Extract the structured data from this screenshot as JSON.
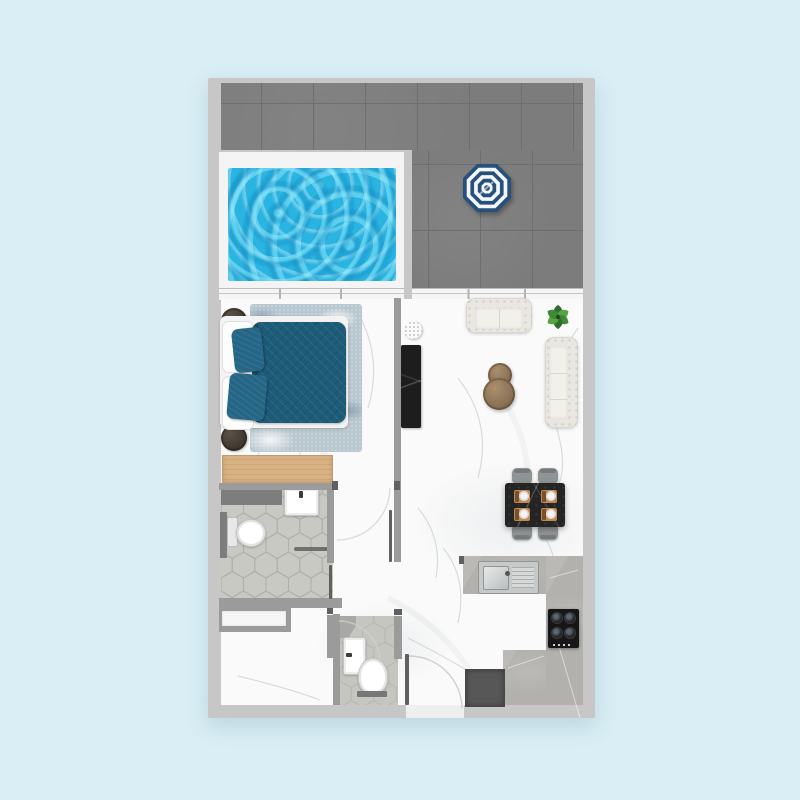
{
  "scene": {
    "kind": "apartment-floor-plan-top-view",
    "units_text_visible": false,
    "text_labels_visible": false
  },
  "colors": {
    "bg": "#d9eef5",
    "outer-wall": "#c7c7c7",
    "inner-wall": "#9b9b9b",
    "wall-dark": "#7d7d7d",
    "terrace-tile": "#7c7c7c",
    "terrace-line": "#6e6e6e",
    "pool-deck": "#f4f4f4",
    "pool-water": "#29b4e1",
    "umbrella-navy": "#27507b",
    "umbrella-white": "#f4f6f8",
    "marble": "#fafafa",
    "marble-vein": "#ccd1d5",
    "window-frame": "#f5f5f5",
    "rug": "#b9c7cf",
    "duvet": "#1d5c79",
    "pillow": "#256687",
    "bed-white": "#f3f3f3",
    "nightstand": "#3e362f",
    "dresser": "#d9b284",
    "dresser-edge": "#c09a6d",
    "sofa": "#e9e7e0",
    "sofa-seat": "#f2f0ea",
    "wood": "#8d7458",
    "wood-dark": "#6f573f",
    "tv": "#1d1d1d",
    "plant-dark": "#2e6d2b",
    "plant-mid": "#3f8a37",
    "plant-light": "#58a344",
    "dining-table": "#242424",
    "chair": "#8f9494",
    "chair-dark": "#757a7a",
    "placemat": "#c08a52",
    "counter": "#b3b1ad",
    "steel": "#c7c9c9",
    "steel-dark": "#8f9595",
    "stove": "#161616",
    "appliance": "#575757",
    "tile": "#c9c9c4",
    "tile-line": "#b0b0ab",
    "tile2": "#c6c6c1",
    "fixture": "#ffffff",
    "fixture-line": "#c4c4c4",
    "door-leaf": "#606060",
    "arc": "#cfcfcf"
  },
  "rooms": [
    {
      "id": "terrace",
      "label": "terrace-with-pool"
    },
    {
      "id": "bedroom",
      "label": "bedroom"
    },
    {
      "id": "living-dining",
      "label": "living-dining-area"
    },
    {
      "id": "kitchen",
      "label": "kitchen"
    },
    {
      "id": "bathroom",
      "label": "en-suite-bathroom"
    },
    {
      "id": "guest-toilet",
      "label": "guest-toilet"
    },
    {
      "id": "entry-hall",
      "label": "entry-hall"
    }
  ],
  "furniture": {
    "terrace": [
      "plunge-pool",
      "striped-parasol"
    ],
    "bedroom": [
      "double-bed-teal",
      "two-teal-pillows",
      "two-round-nightstands",
      "area-rug",
      "wood-dresser"
    ],
    "living": [
      "tufted-loveseat",
      "tufted-sofa",
      "two-round-coffee-tables",
      "tv-console",
      "monstera-plant",
      "small-round-plant"
    ],
    "dining": [
      "black-marble-table",
      "four-gray-chairs",
      "four-place-settings"
    ],
    "kitchen": [
      "l-shaped-counter",
      "stainless-sink",
      "four-burner-cooktop",
      "dark-appliance"
    ],
    "bathroom": [
      "toilet",
      "washbasin",
      "towel-rail",
      "hex-tile-floor"
    ],
    "guest_toilet": [
      "toilet",
      "washbasin"
    ]
  }
}
